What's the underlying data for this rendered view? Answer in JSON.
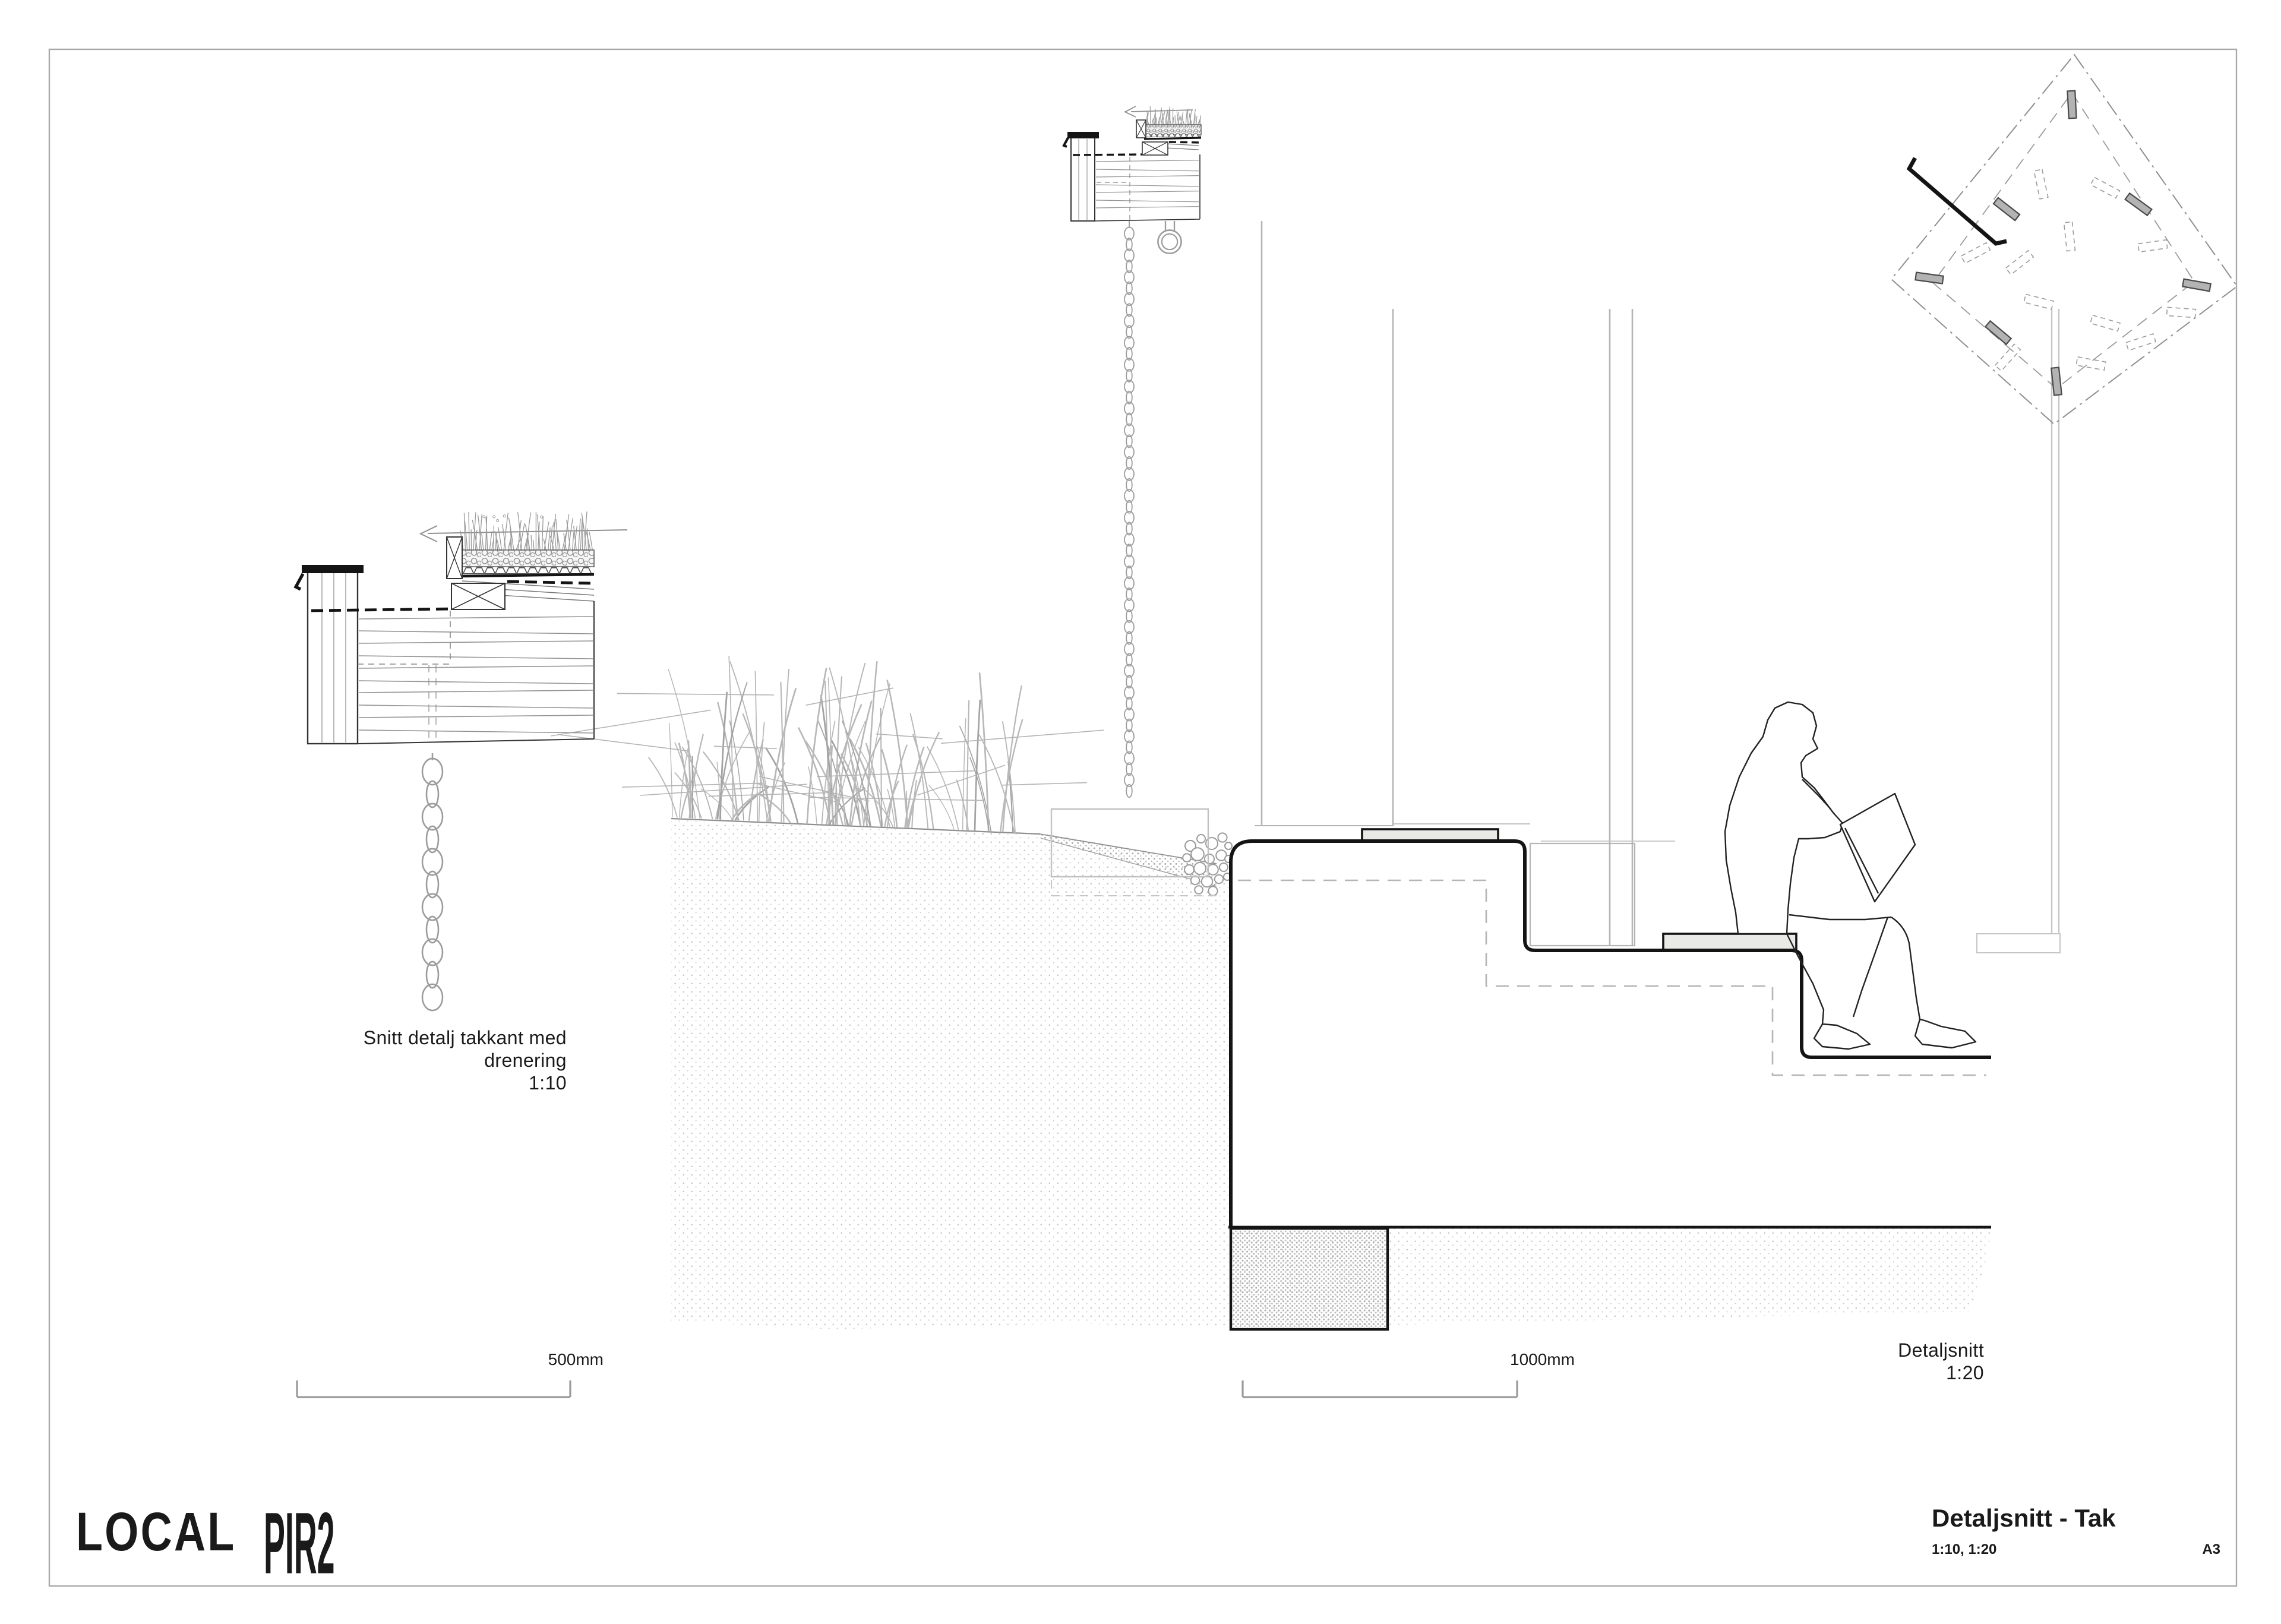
{
  "sheet": {
    "detail_110": {
      "label_line1": "Snitt detalj takkant med",
      "label_line2": "drenering",
      "label_line3": "1:10",
      "scale_bar_label": "500mm"
    },
    "detail_120": {
      "label_line1": "Detaljsnitt",
      "label_line2": "1:20",
      "scale_bar_label": "1000mm"
    },
    "footer": {
      "logo_local": "LOCAL",
      "logo_pir2": "PIR2"
    },
    "title_block": {
      "title": "Detaljsnitt - Tak",
      "scales": "1:10, 1:20",
      "sheet_size": "A3"
    },
    "colors": {
      "ink": "#141414",
      "line_gray": "#8f8f8f",
      "light_gray": "#b5b5b5",
      "slab_fill": "#e9e9e6",
      "bar_fill": "#b3b3b3",
      "frame": "#a9a9a9"
    }
  }
}
